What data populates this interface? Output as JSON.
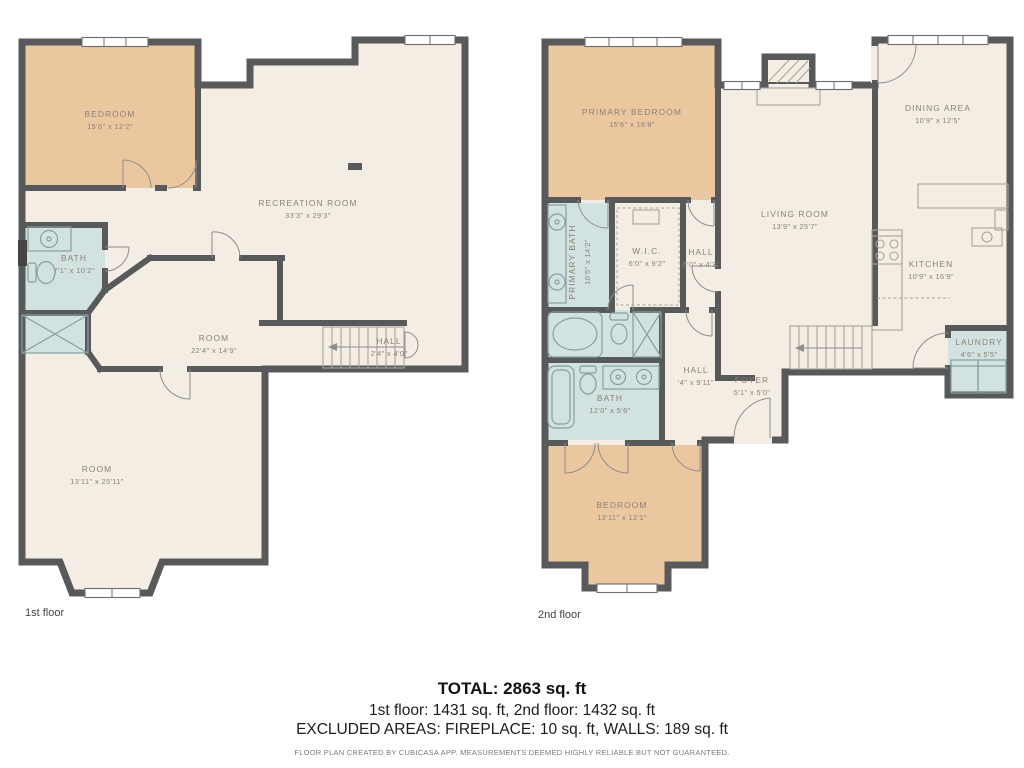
{
  "colors": {
    "wall": "#58595b",
    "floor_neutral": "#f4ede3",
    "bedroom_fill": "#ebc7a0",
    "wet_room_fill": "#d2e2e1",
    "label_text": "#8c8177"
  },
  "floors": [
    {
      "caption": "1st floor",
      "rooms": [
        {
          "name": "BEDROOM",
          "dims": "15'6\" x 12'2\""
        },
        {
          "name": "RECREATION ROOM",
          "dims": "33'3\" x 29'3\""
        },
        {
          "name": "BATH",
          "dims": "7'1\" x 10'2\""
        },
        {
          "name": "ROOM",
          "dims": "22'4\" x 14'9\""
        },
        {
          "name": "HALL",
          "dims": "2'4\" x 4'0\""
        },
        {
          "name": "ROOM",
          "dims": "13'11\" x 25'11\""
        }
      ]
    },
    {
      "caption": "2nd floor",
      "rooms": [
        {
          "name": "PRIMARY BEDROOM",
          "dims": "15'6\" x 16'8\""
        },
        {
          "name": "PRIMARY BATH",
          "dims": "10'5\" x 14'2\""
        },
        {
          "name": "W.I.C.",
          "dims": "6'0\" x 9'2\""
        },
        {
          "name": "HALL",
          "dims": "5'0\" x 4'3\""
        },
        {
          "name": "DINING AREA",
          "dims": "10'9\" x 12'5\""
        },
        {
          "name": "LIVING ROOM",
          "dims": "13'9\" x 25'7\""
        },
        {
          "name": "KITCHEN",
          "dims": "10'9\" x 16'9\""
        },
        {
          "name": "BATH",
          "dims": "12'0\" x 5'6\""
        },
        {
          "name": "HALL",
          "dims": "'4\" x 9'11\""
        },
        {
          "name": "FOYER",
          "dims": "5'1\" x 5'0\""
        },
        {
          "name": "LAUNDRY",
          "dims": "4'6\" x 5'5\""
        },
        {
          "name": "BEDROOM",
          "dims": "13'11\" x 12'1\""
        }
      ]
    }
  ],
  "summary": {
    "total": "TOTAL: 2863 sq. ft",
    "floors_line": "1st floor: 1431 sq. ft, 2nd floor: 1432 sq. ft",
    "excluded_line": "EXCLUDED AREAS: FIREPLACE: 10 sq. ft, WALLS: 189 sq. ft"
  },
  "footer": "FLOOR PLAN CREATED BY CUBICASA APP. MEASUREMENTS DEEMED HIGHLY RELIABLE BUT NOT GUARANTEED."
}
